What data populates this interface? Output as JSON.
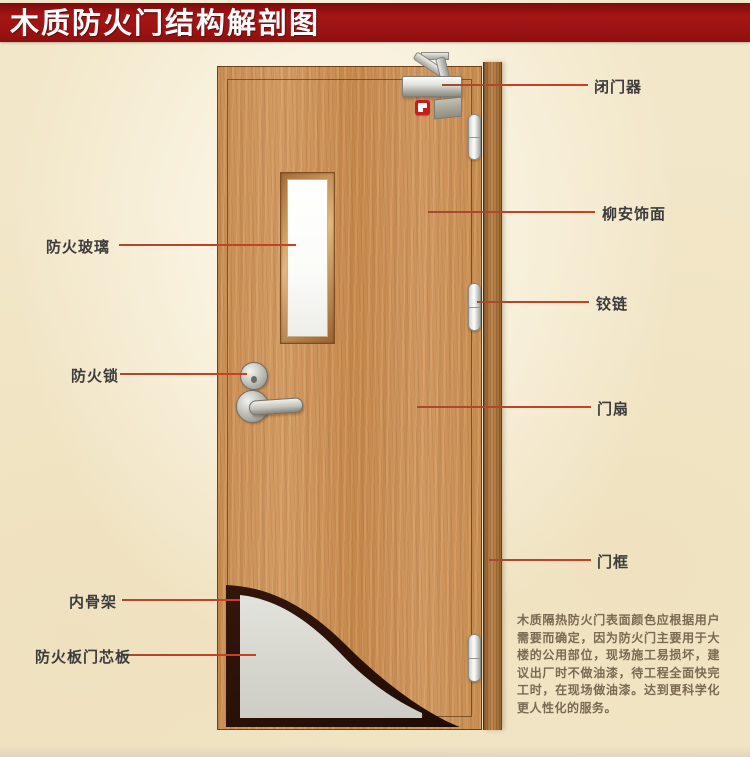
{
  "title": "木质防火门结构解剖图",
  "labels": {
    "fire_glass": "防火玻璃",
    "fire_lock": "防火锁",
    "inner_skeleton": "内骨架",
    "fire_board_core": "防火板门芯板",
    "door_closer": "闭门器",
    "lauan_veneer": "柳安饰面",
    "hinge": "铰链",
    "door_leaf": "门扇",
    "door_frame": "门框"
  },
  "note": {
    "text": "木质隔热防火门表面颜色应根据用户需要而确定，因为防火门主要用于大楼的公用部位，现场施工易损坏，建议出厂时不做油漆，待工程全面快完工时，在现场做油漆。达到更科学化更人性化的服务。"
  },
  "colors": {
    "banner_red": "#9a1212",
    "leader_line_red": "#c4442c",
    "door_wood": "#cd9055",
    "frame_wood": "#a9763d",
    "core_board_grey": "#d8d8d2",
    "skeleton_dark": "#2b1207",
    "background_parchment": "#f2e7c9",
    "label_text": "#3c3c3c",
    "note_text": "#7b6a52"
  }
}
